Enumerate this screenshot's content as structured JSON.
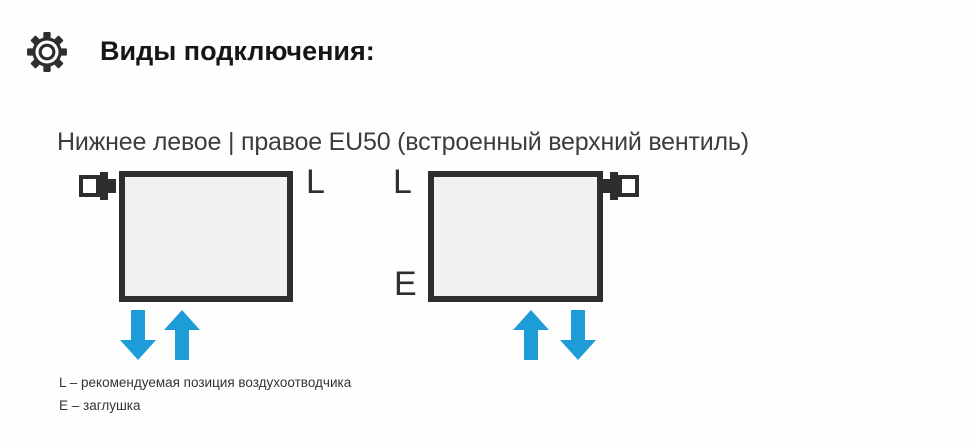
{
  "header": {
    "icon": "gear-icon",
    "title": "Виды подключения:"
  },
  "section": {
    "subtitle": "Нижнее левое | правое EU50 (встроенный верхний вентиль)",
    "diagrams": [
      {
        "id": "bottom-left-connection",
        "air_vent_label": "L",
        "arrows": [
          "down",
          "up"
        ]
      },
      {
        "id": "bottom-right-connection",
        "air_vent_label": "L",
        "plug_label": "E",
        "arrows": [
          "up",
          "down"
        ]
      }
    ],
    "legend": [
      "L – рекомендуемая позиция воздухоотводчика",
      "E – заглушка"
    ]
  },
  "colors": {
    "arrow_blue": "#1e9cd7",
    "outline_dark": "#2e2e2e",
    "radiator_fill": "#f1f1f1"
  }
}
